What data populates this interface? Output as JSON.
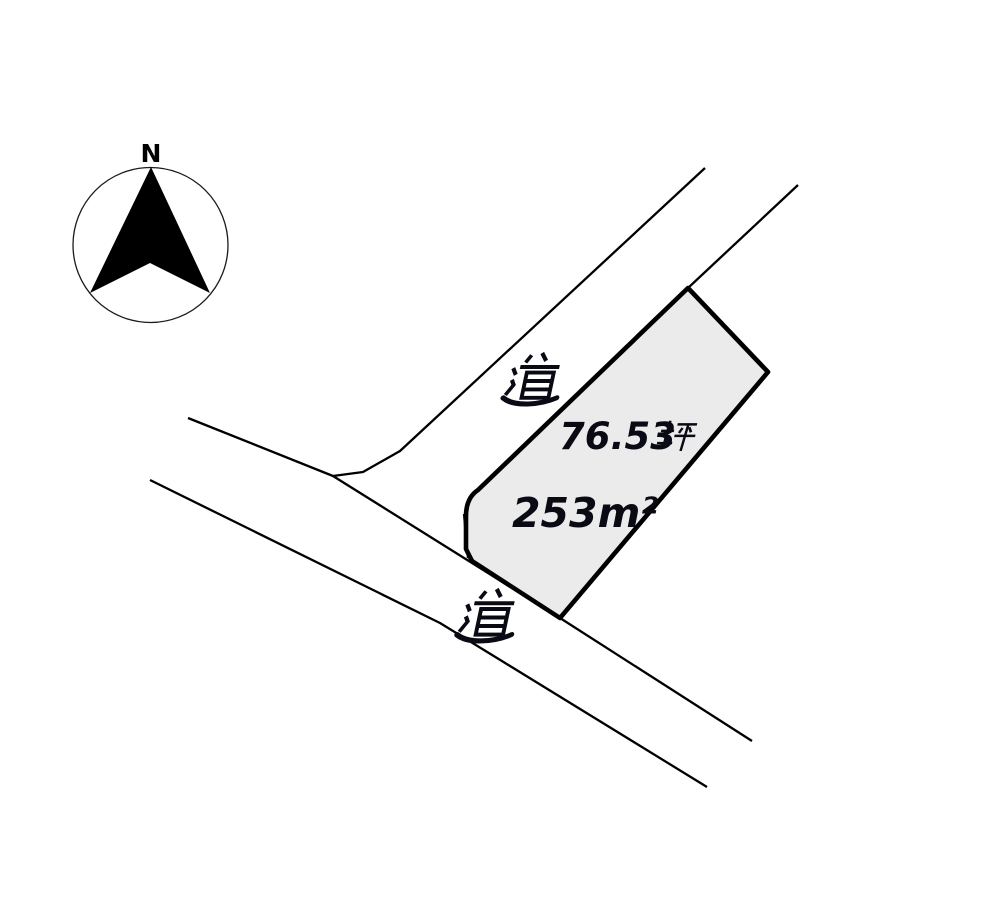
{
  "background_color": "#ffffff",
  "line_color": "#000000",
  "compass": {
    "label": "N"
  },
  "roads": {
    "upper_label": "道",
    "lower_label": "道"
  },
  "parcel": {
    "area_tsubo_value": "76.53",
    "area_tsubo_unit": "坪",
    "area_sqm_label": "253m²",
    "fill_color": "#ebebeb"
  }
}
